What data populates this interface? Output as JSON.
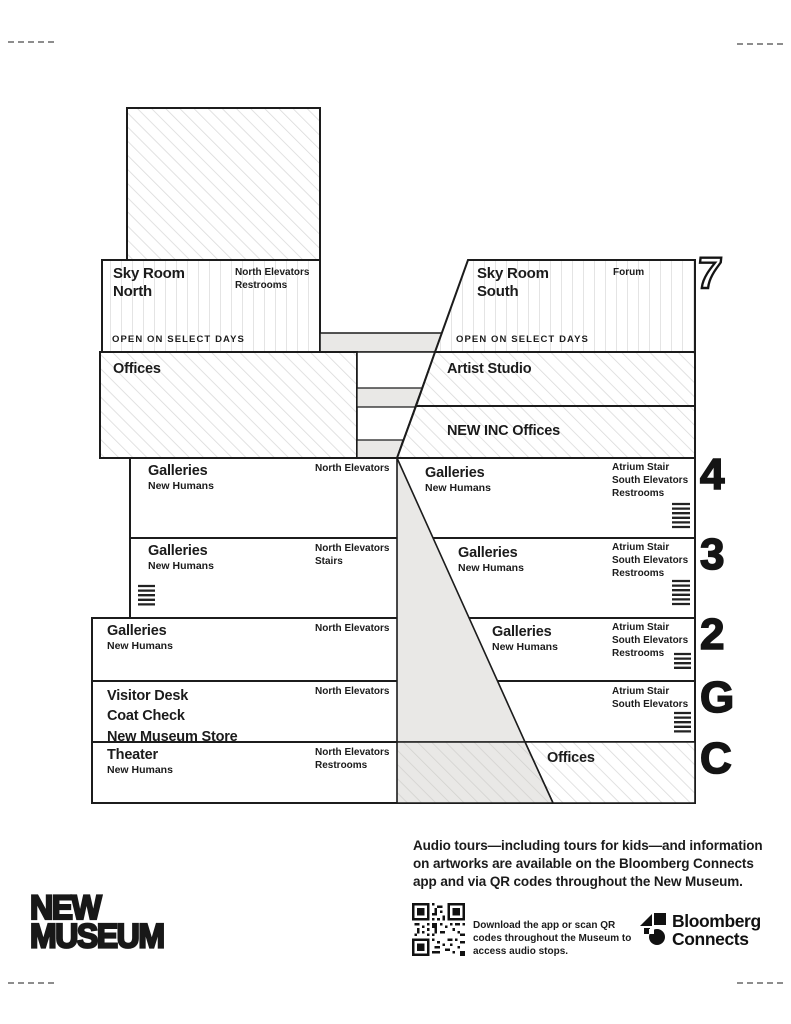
{
  "building": {
    "f7": {
      "label": "7",
      "north": {
        "title": "Sky Room\nNorth",
        "services": "North Elevators\nRestrooms",
        "note": "OPEN ON SELECT DAYS"
      },
      "south": {
        "title": "Sky Room\nSouth",
        "services": "Forum",
        "note": "OPEN ON SELECT DAYS"
      }
    },
    "mezz": {
      "offices": "Offices",
      "artist_studio": "Artist Studio",
      "new_inc": "NEW INC Offices"
    },
    "f4": {
      "label": "4",
      "left_title": "Galleries",
      "left_sub": "New Humans",
      "mid_services": "North Elevators",
      "right_title": "Galleries",
      "right_sub": "New Humans",
      "right_services": "Atrium Stair\nSouth Elevators\nRestrooms"
    },
    "f3": {
      "label": "3",
      "left_title": "Galleries",
      "left_sub": "New Humans",
      "mid_services": "North Elevators\nStairs",
      "right_title": "Galleries",
      "right_sub": "New Humans",
      "right_services": "Atrium Stair\nSouth Elevators\nRestrooms"
    },
    "f2": {
      "label": "2",
      "left_title": "Galleries",
      "left_sub": "New Humans",
      "mid_services": "North Elevators",
      "right_title": "Galleries",
      "right_sub": "New Humans",
      "right_services": "Atrium Stair\nSouth Elevators\nRestrooms"
    },
    "fg": {
      "label": "G",
      "left_title": "Visitor Desk\nCoat Check\nNew Museum Store",
      "mid_services": "North Elevators",
      "right_services": "Atrium Stair\nSouth Elevators"
    },
    "fc": {
      "label": "C",
      "left_title": "Theater",
      "left_sub": "New Humans",
      "mid_services": "North Elevators\nRestrooms",
      "right_title": "Offices"
    }
  },
  "footer": {
    "blurb": "Audio tours—including tours for kids—and information\non artworks are available on the Bloomberg Connects\napp and via QR codes throughout the New Museum.",
    "wordmark_line1": "NEW",
    "wordmark_line2": "MUSEUM",
    "qr_caption": "Download the app or scan QR\ncodes throughout the Museum to\naccess audio stops.",
    "bloomberg": "Bloomberg\nConnects"
  },
  "colors": {
    "ink": "#1c1c1c",
    "slab_gray": "#e9e8e6",
    "hatch_gray": "#d8d8d8"
  }
}
